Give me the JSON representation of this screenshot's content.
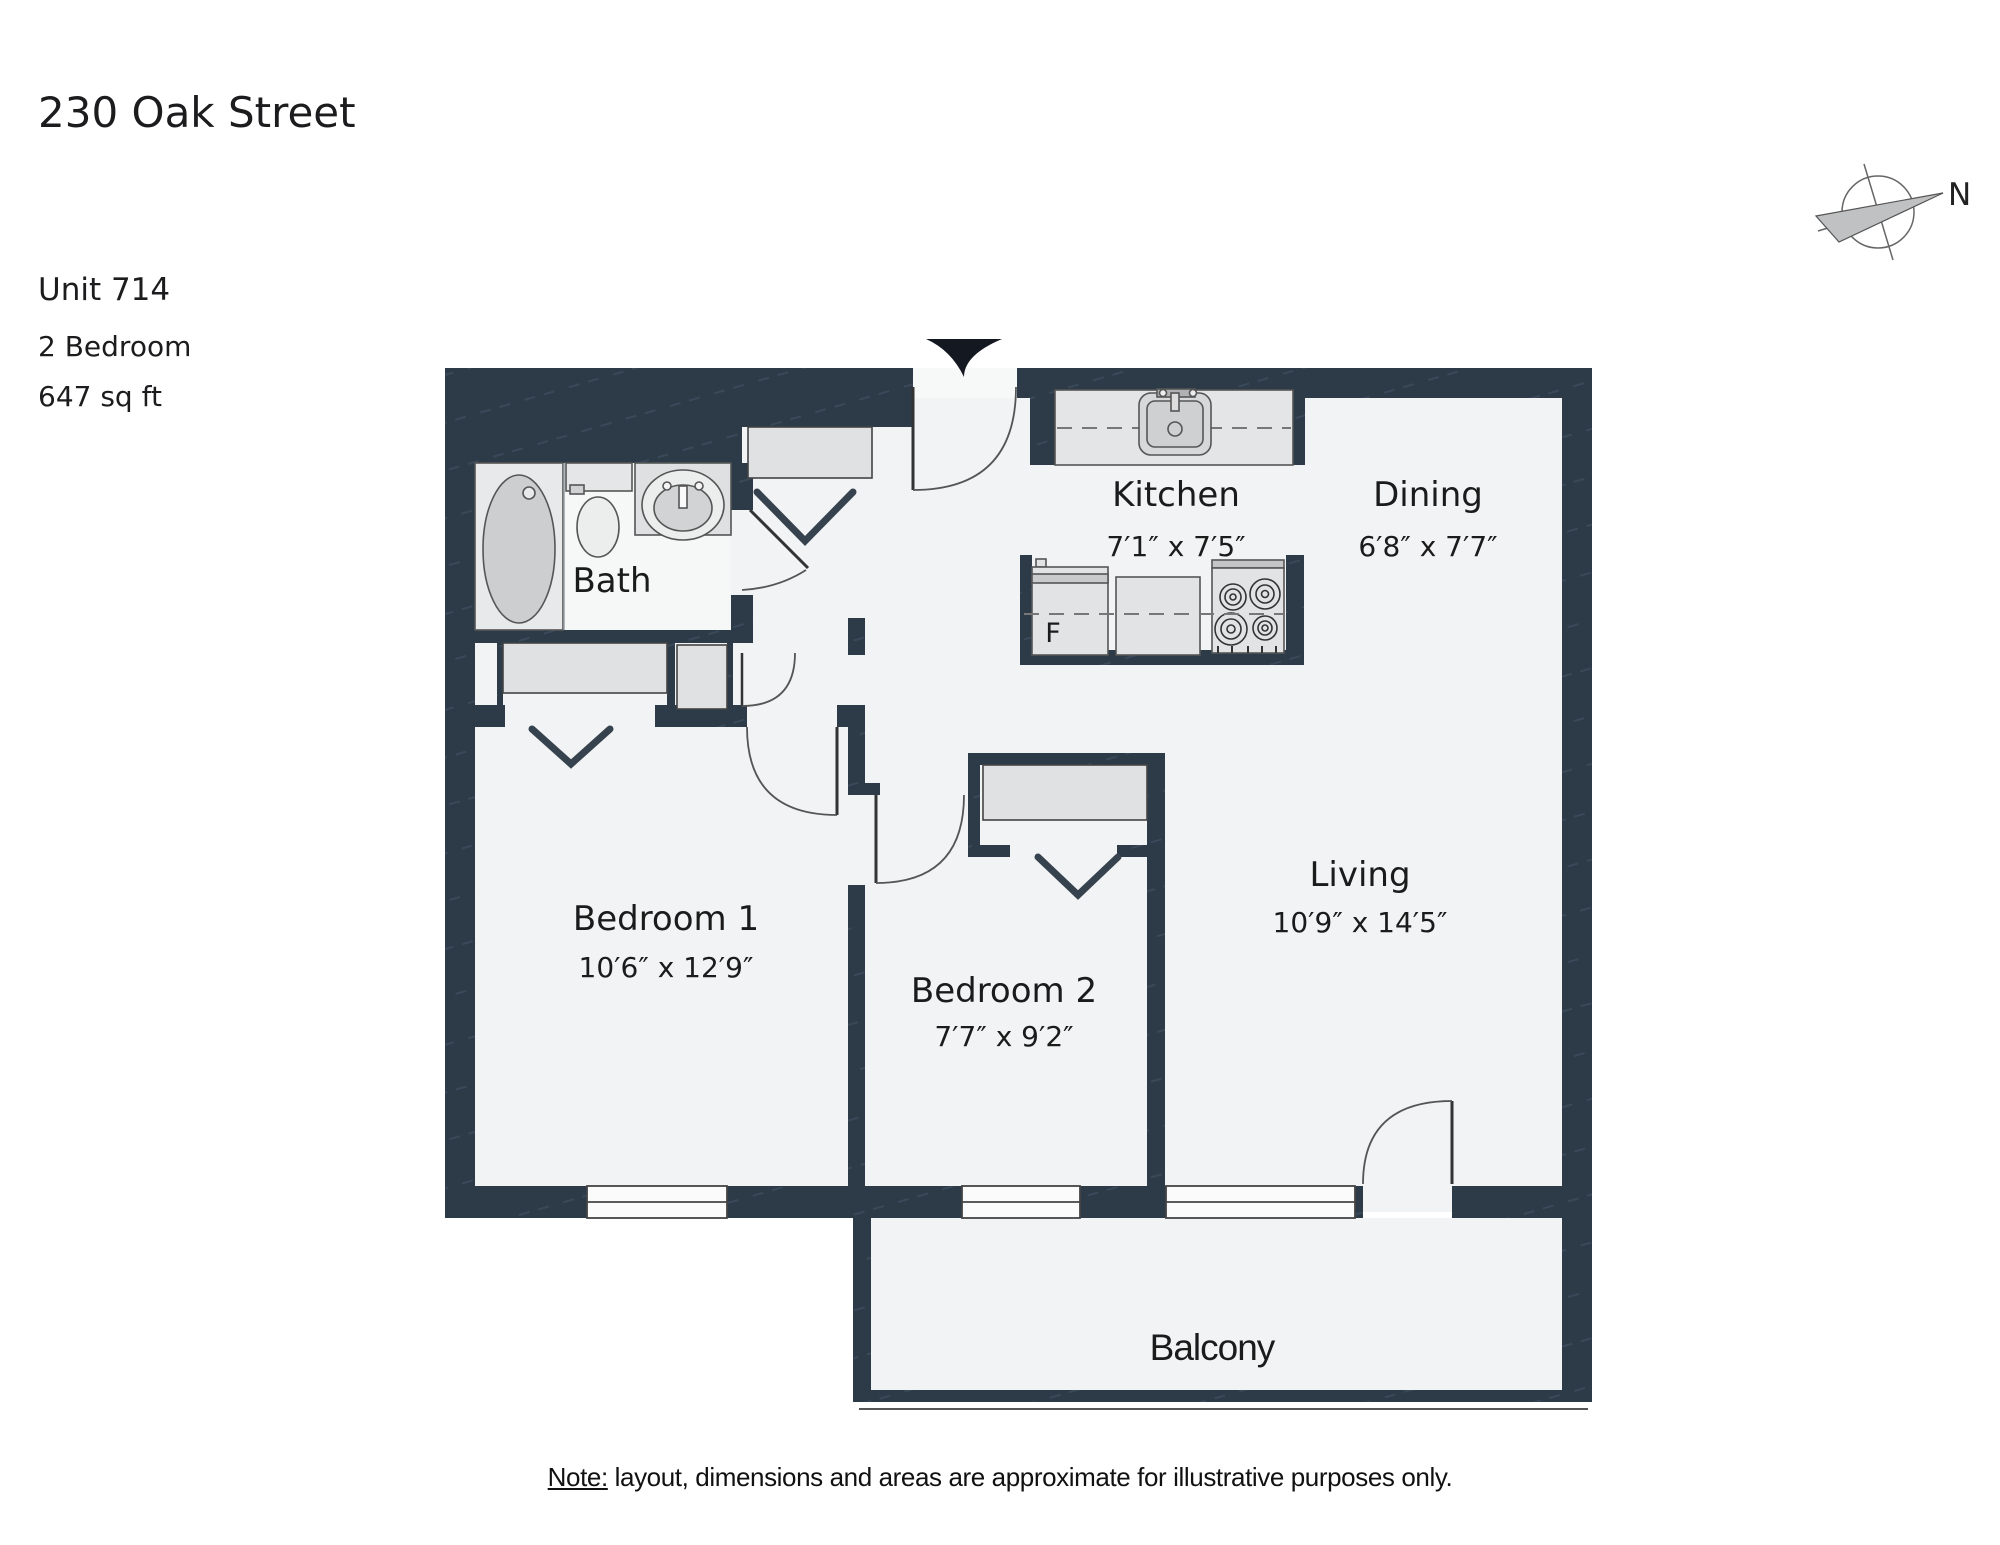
{
  "header": {
    "address": "230 Oak Street",
    "unit": "Unit 714",
    "bedrooms": "2 Bedroom",
    "area": "647 sq ft"
  },
  "compass": {
    "north": "N"
  },
  "rooms": {
    "bath": {
      "label": "Bath"
    },
    "kitchen": {
      "label": "Kitchen",
      "dims": "7′1″ x 7′5″"
    },
    "dining": {
      "label": "Dining",
      "dims": "6′8″ x 7′7″"
    },
    "living": {
      "label": "Living",
      "dims": "10′9″ x 14′5″"
    },
    "bedroom1": {
      "label": "Bedroom 1",
      "dims": "10′6″ x 12′9″"
    },
    "bedroom2": {
      "label": "Bedroom 2",
      "dims": "7′7″ x 9′2″"
    },
    "balcony": {
      "label": "Balcony"
    }
  },
  "appliances": {
    "fridge": "F"
  },
  "note": {
    "label": "Note:",
    "text": "layout, dimensions and areas are approximate for illustrative purposes only."
  },
  "colors": {
    "wall": "#2d3a48",
    "floor": "#f2f3f4",
    "fixture": "#e3e4e5",
    "text": "#1c1c1e"
  }
}
